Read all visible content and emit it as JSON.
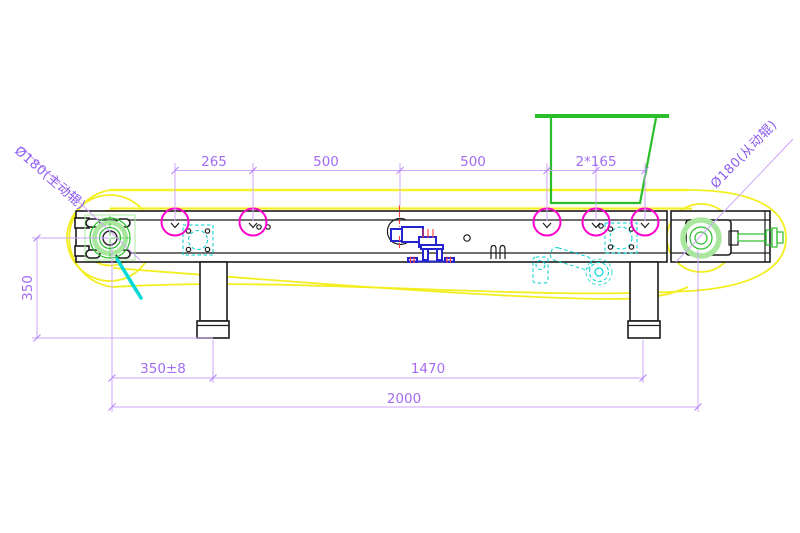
{
  "drawing": {
    "type": "conveyor-assembly-cad-drawing",
    "dimensions": {
      "top_chain": [
        "265",
        "500",
        "500",
        "2*165"
      ],
      "drum_height": "350",
      "leg_offset": "350±8",
      "leg_spacing": "1470",
      "overall_length": "2000"
    },
    "leaders": {
      "left_drum": "Ø180(主动辊)",
      "right_drum": "Ø180(从动辊)"
    },
    "colors": {
      "dimension_line": "#cda4fb",
      "dimension_text": "#a36bf2",
      "leader_text": "#8d5cf0",
      "marker_magenta": "#ff00cc",
      "belt_yellow": "#f2ee1f",
      "hopper_green": "#2abf2a",
      "drum_green_light": "#a9e79e",
      "detail_cyan": "#00d9d9",
      "motor_blue": "#2525cf",
      "hatch_red": "#ff3b3b",
      "outline_black": "#1b1b1b"
    }
  }
}
